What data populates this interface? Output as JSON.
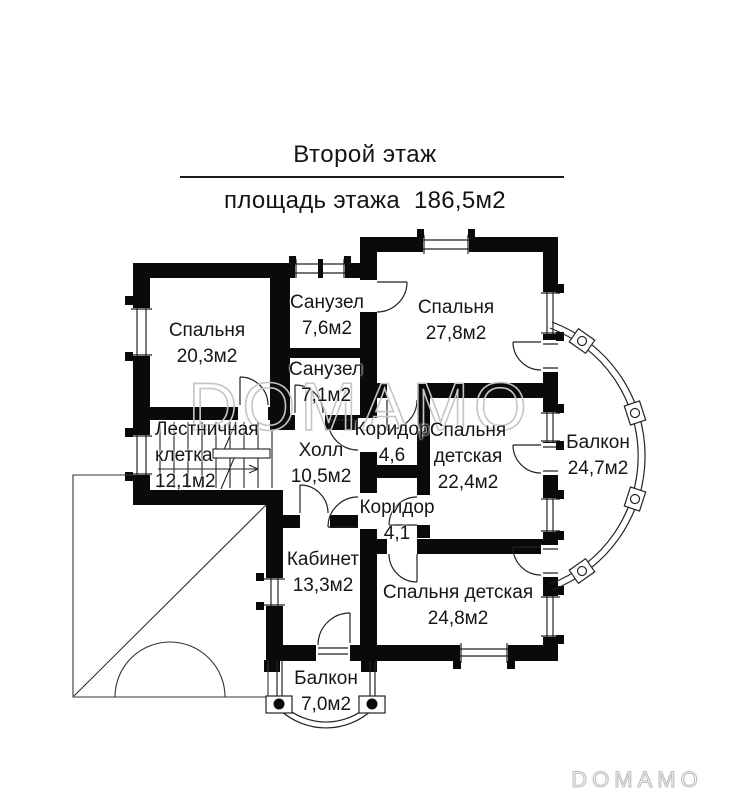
{
  "header": {
    "title": "Второй этаж",
    "subtitle": "площадь этажа  186,5м2"
  },
  "rooms": [
    {
      "name": "Спальня",
      "area": "20,3м2"
    },
    {
      "name": "Санузел",
      "area": "7,6м2"
    },
    {
      "name": "Спальня",
      "area": "27,8м2"
    },
    {
      "name": "Санузел",
      "area": "7,1м2"
    },
    {
      "name": "Коридор",
      "area": "4,6"
    },
    {
      "name": "Спальня детская",
      "area": "22,4м2"
    },
    {
      "name": "Балкон",
      "area": "24,7м2"
    },
    {
      "name": "Лестничная клетка",
      "area": "12,1м2"
    },
    {
      "name": "Холл",
      "area": "10,5м2"
    },
    {
      "name": "Коридор",
      "area": "4,1"
    },
    {
      "name": "Кабинет",
      "area": "13,3м2"
    },
    {
      "name": "Спальня детская",
      "area": "24,8м2"
    },
    {
      "name": "Балкон",
      "area": "7,0м2"
    }
  ],
  "watermark": "DOMAMO",
  "logo": "DOMAMO",
  "colors": {
    "wall": "#0a0a0a",
    "line": "#222222",
    "watermark": "#c5c5c5"
  }
}
